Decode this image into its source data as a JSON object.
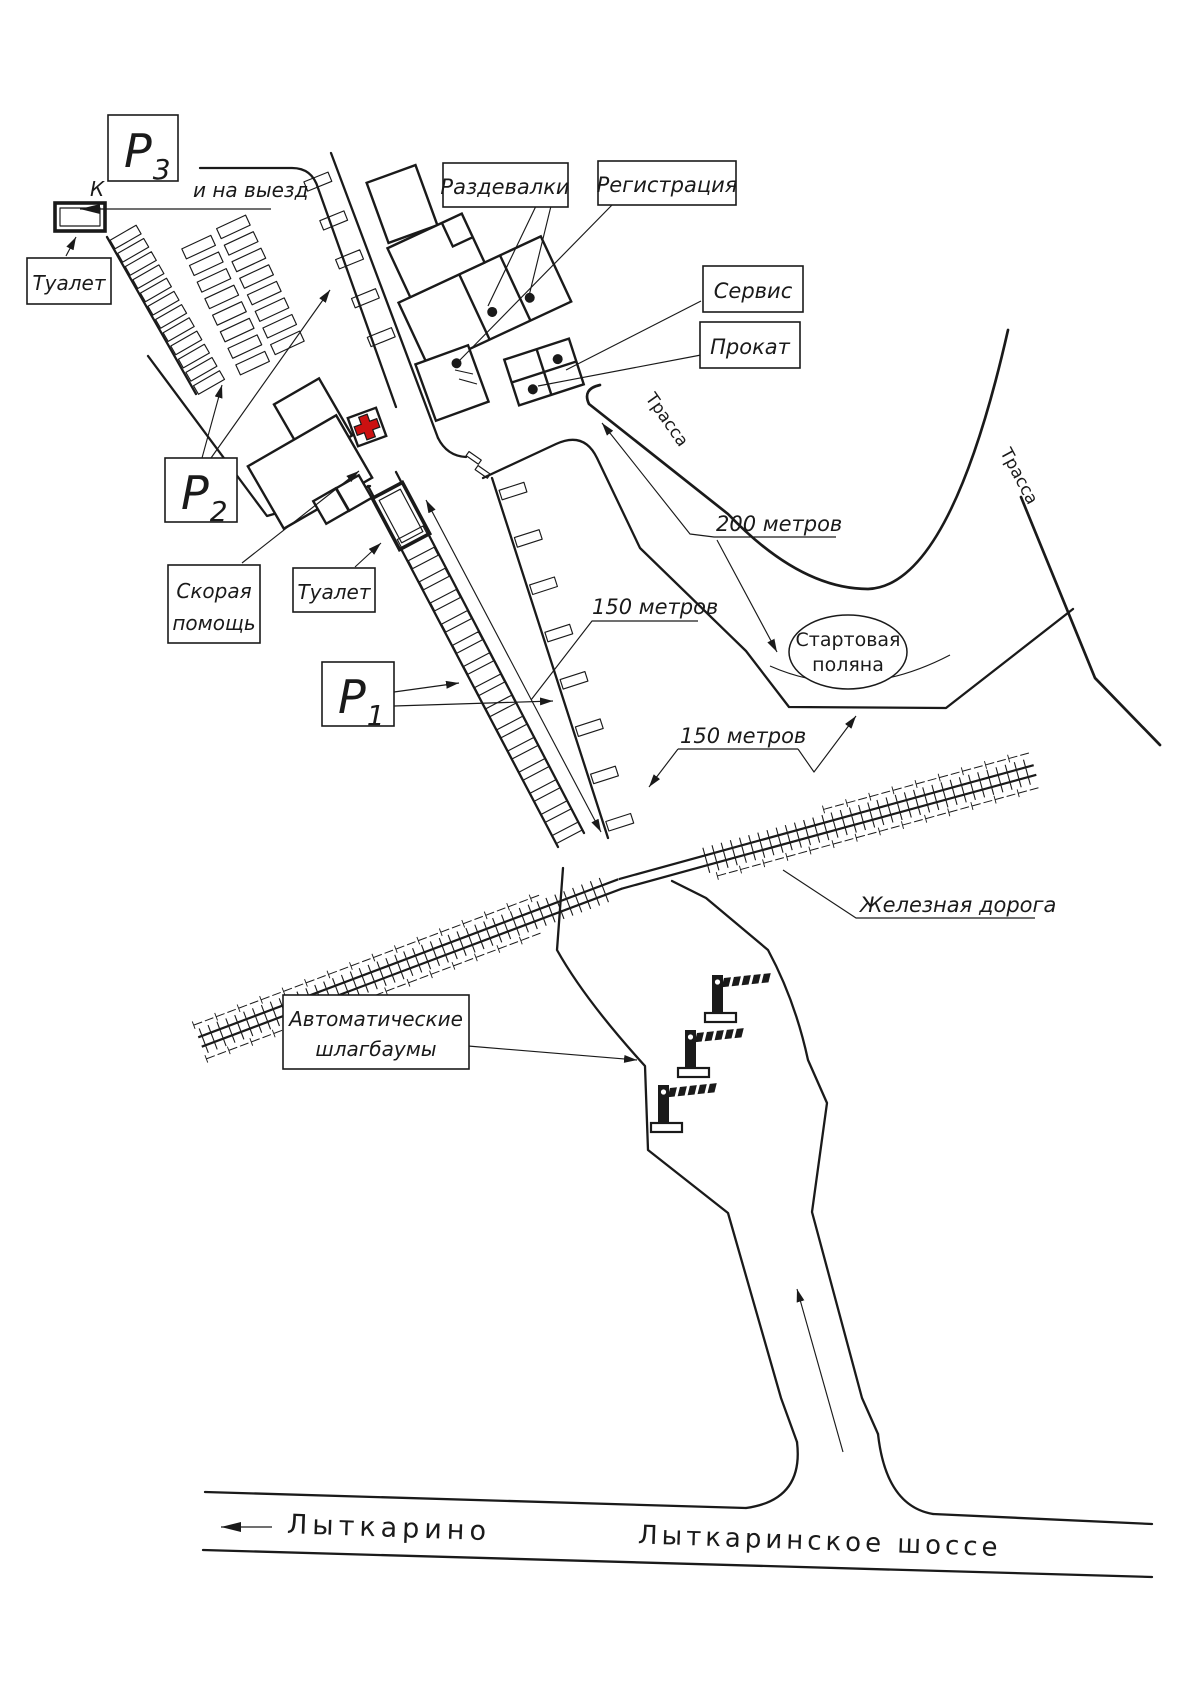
{
  "map": {
    "parking": {
      "p1": {
        "letter": "Р",
        "sub": "1"
      },
      "p2": {
        "letter": "Р",
        "sub": "2"
      },
      "p3": {
        "letter": "Р",
        "sub": "3"
      }
    },
    "labels": {
      "k": "К",
      "to_exit": "и на выезд",
      "toilet_top": "Туалет",
      "toilet_mid": "Туалет",
      "changing": "Раздевалки",
      "registration": "Регистрация",
      "service": "Сервис",
      "rental": "Прокат",
      "first_aid": [
        "Скорая",
        "помощь"
      ],
      "barriers": [
        "Автоматические",
        "шлагбаумы"
      ],
      "track": "Трасса",
      "railway": "Железная дорога",
      "start_glade": [
        "Стартовая",
        "поляна"
      ],
      "dist_200": "200 метров",
      "dist_150": "150 метров",
      "lytkarino": "Лыткарино",
      "highway": "Лыткаринское шоссе"
    },
    "colors": {
      "ink": "#1a1a1a",
      "cross": "#cc1111",
      "paper": "#ffffff"
    }
  }
}
